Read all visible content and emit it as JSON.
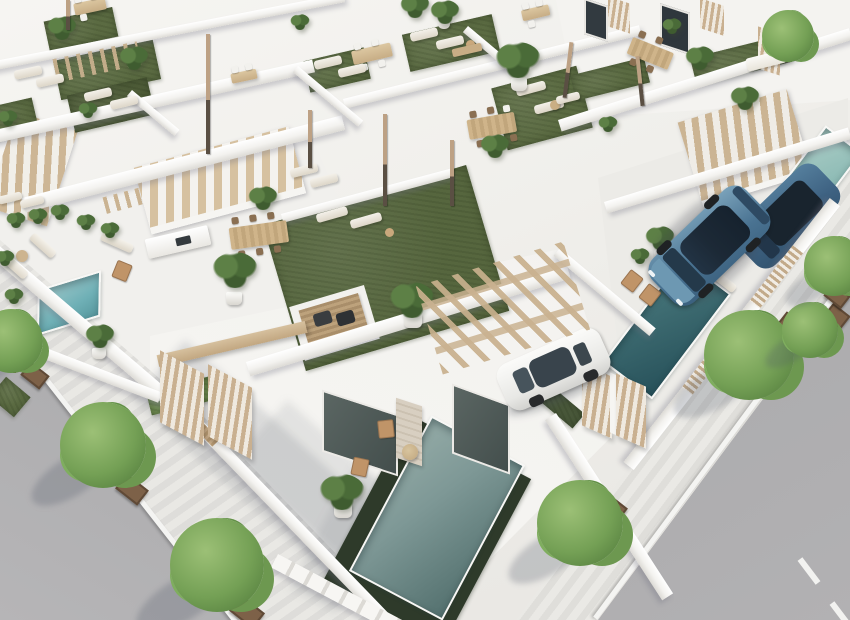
{
  "scene": {
    "title": "Aerial 3D architectural rendering of a modern white villa development with rooftop turf terraces, private pools, parked cars and tree-lined streets",
    "time_of_day": "bright daylight, sun from upper right",
    "camera": "high-angle aerial view, streets running diagonally",
    "palette": {
      "wall_white": "#f5f4f1",
      "wall_shade": "#dcdad5",
      "turf_green": "#5b6b42",
      "turf_dark_edge": "#2e3a2a",
      "hedge_green": "#6d8a4f",
      "pool_turquoise": "#6fb0b6",
      "pool_teal_dark": "#2f575e",
      "pool_gray_teal": "#6f8c8a",
      "pool_pale": "#9cc3bd",
      "wood_tan": "#c8b091",
      "stair_tread": "#cdb695",
      "road_asphalt": "#9e9ea0",
      "sidewalk_paving": "#e2e1dd",
      "tree_foliage": "#74a055",
      "planter_brown": "#7d6148",
      "suv_blue": "#4f7d9e",
      "car_white": "#f4f4f2",
      "glass_dark": "#1c2936"
    },
    "objects": {
      "main_villa": "Foreground villa with rooftop turf terrace, timber pergola carport and glass facade",
      "main_pool": "Long rectangular pool with dark green turf surround at the front villa",
      "courtyard_pool": "Dark teal courtyard pool beside the parked SUV",
      "corner_pool": "Small turquoise plunge pool in the walled corner patio",
      "pale_pool": "Pale plunge pool beside the outdoor staircase",
      "blue_suv": "Steel-blue SUV parked on the gravel courtyard",
      "blue_suv_2": "Second blue SUV behind the slatted fence",
      "white_car": "White car parked under the pergola carport",
      "left_street": "Asphalt street with white curb line at lower left",
      "right_street": "Asphalt street with dashed lane marking at lower right",
      "sidewalk_trees": "Deciduous street trees in square timber planters",
      "rooftop_terraces": "Rooftop terraces with artificial turf, sun loungers, dining sets, potted palms and closed parasols",
      "staircases": "Outdoor staircases with timber treads and white stringers",
      "dining_sets": "Timber dining tables with rattan and white chairs",
      "kitchen_counter": "White outdoor kitchen counter with dark sink",
      "pergola": "Timber-beam pergola shading the carport",
      "deck_mat": "Timber deck mat with dark floor cushions on the main roof terrace",
      "slat_fence": "Vertical timber slat fence panels along the street wall"
    },
    "counts": {
      "pools": 4,
      "cars": 3,
      "street_trees": 8,
      "turf_patches": 13,
      "closed_parasols": 7,
      "staircases": 3,
      "dining_sets": 7
    }
  }
}
